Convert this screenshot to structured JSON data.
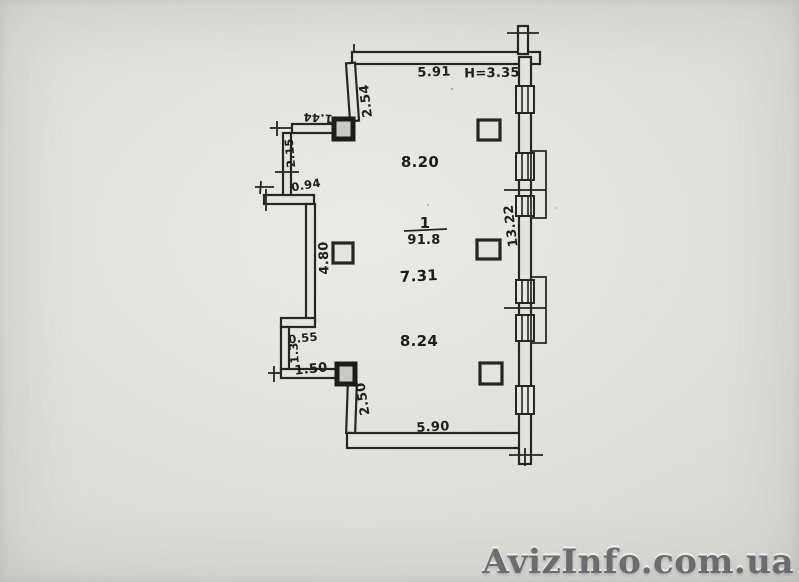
{
  "watermark": {
    "text": "AvizInfo.com.ua"
  },
  "plan": {
    "room_number": "1",
    "room_area": "91.8",
    "ceiling_height": "H=3.35",
    "labels": {
      "top_width": "5.91",
      "nw_wall": "2.54",
      "niche_top": "1.44",
      "niche_side": "2.15",
      "niche_bottom": "0.94",
      "west_wall": "4.80",
      "jog": "0.55",
      "jog_side": "1.3",
      "sw_top": "1.50",
      "sw_wall": "2.50",
      "bottom_width": "5.90",
      "east_wall": "13.22",
      "width_upper": "8.20",
      "width_middle": "7.31",
      "width_lower": "8.24"
    }
  }
}
